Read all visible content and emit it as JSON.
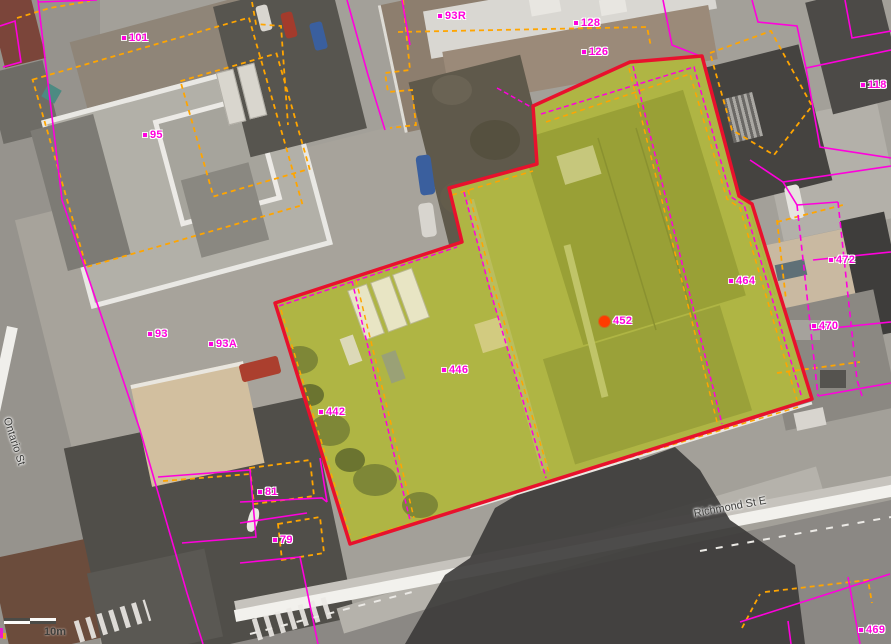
{
  "map": {
    "parcel_labels": [
      {
        "text": "101",
        "x": 126,
        "y": 38
      },
      {
        "text": "95",
        "x": 147,
        "y": 135
      },
      {
        "text": "93R",
        "x": 442,
        "y": 16
      },
      {
        "text": "128",
        "x": 578,
        "y": 23
      },
      {
        "text": "126",
        "x": 586,
        "y": 52
      },
      {
        "text": "118",
        "x": 865,
        "y": 85
      },
      {
        "text": "93",
        "x": 152,
        "y": 334
      },
      {
        "text": "93A",
        "x": 213,
        "y": 344
      },
      {
        "text": "472",
        "x": 833,
        "y": 260
      },
      {
        "text": "464",
        "x": 733,
        "y": 281
      },
      {
        "text": "470",
        "x": 816,
        "y": 326
      },
      {
        "text": "452",
        "x": 605,
        "y": 320,
        "marker": "selected-point"
      },
      {
        "text": "446",
        "x": 446,
        "y": 370
      },
      {
        "text": "442",
        "x": 323,
        "y": 412
      },
      {
        "text": "81",
        "x": 262,
        "y": 492
      },
      {
        "text": "79",
        "x": 277,
        "y": 540
      },
      {
        "text": "469",
        "x": 863,
        "y": 630
      }
    ],
    "street_labels": [
      {
        "text": "Richmond St E",
        "x": 694,
        "y": 508,
        "angle": -10.5
      },
      {
        "text": "Ontario St",
        "x": 12,
        "y": 416,
        "angle": 72
      }
    ],
    "scale_bar": {
      "label": "10m"
    },
    "selected_point": {
      "parcel": "452"
    },
    "colors": {
      "parcel_line": "#FF00DD",
      "secondary_parcel_line": "#FFA500",
      "selection_outline": "#E8112D",
      "selection_fill": "#AFB544",
      "selected_point": "#FF3C00",
      "label_text": "#FF00DD",
      "street_label_text": "#3C3C3A"
    }
  }
}
